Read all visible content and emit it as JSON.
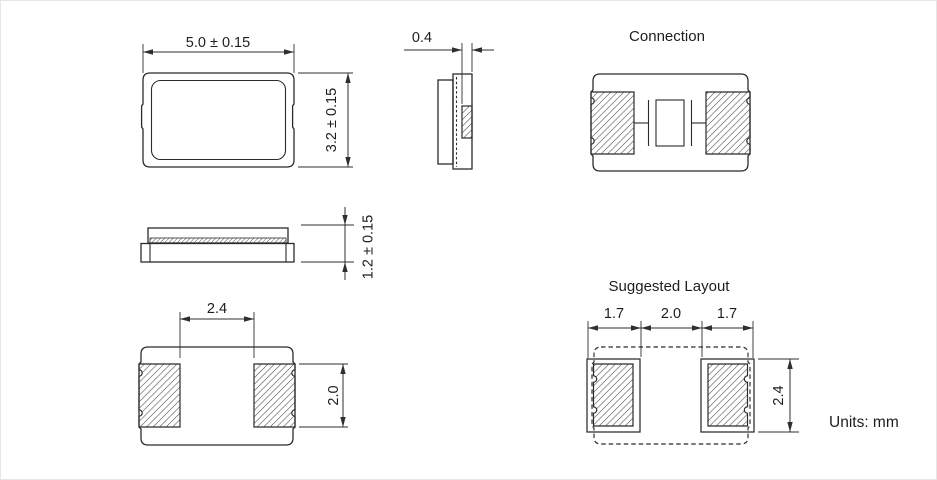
{
  "drawing": {
    "ink_color": "#2b2b2b",
    "hatch_color": "#3f3f3f",
    "background_color": "#ffffff"
  },
  "top_view": {
    "width_dim": "5.0 ± 0.15",
    "height_dim": "3.2 ± 0.15"
  },
  "end_view": {
    "terminal_width_dim": "0.4"
  },
  "connection_view": {
    "title": "Connection"
  },
  "side_view": {
    "thickness_dim": "1.2 ± 0.15"
  },
  "bottom_view": {
    "pad_gap_dim": "2.4",
    "pad_height_dim": "2.0"
  },
  "suggested_layout": {
    "title": "Suggested Layout",
    "left_pad_width_dim": "1.7",
    "pad_gap_dim": "2.0",
    "right_pad_width_dim": "1.7",
    "pad_height_dim": "2.4"
  },
  "footer": {
    "units": "Units: mm"
  }
}
